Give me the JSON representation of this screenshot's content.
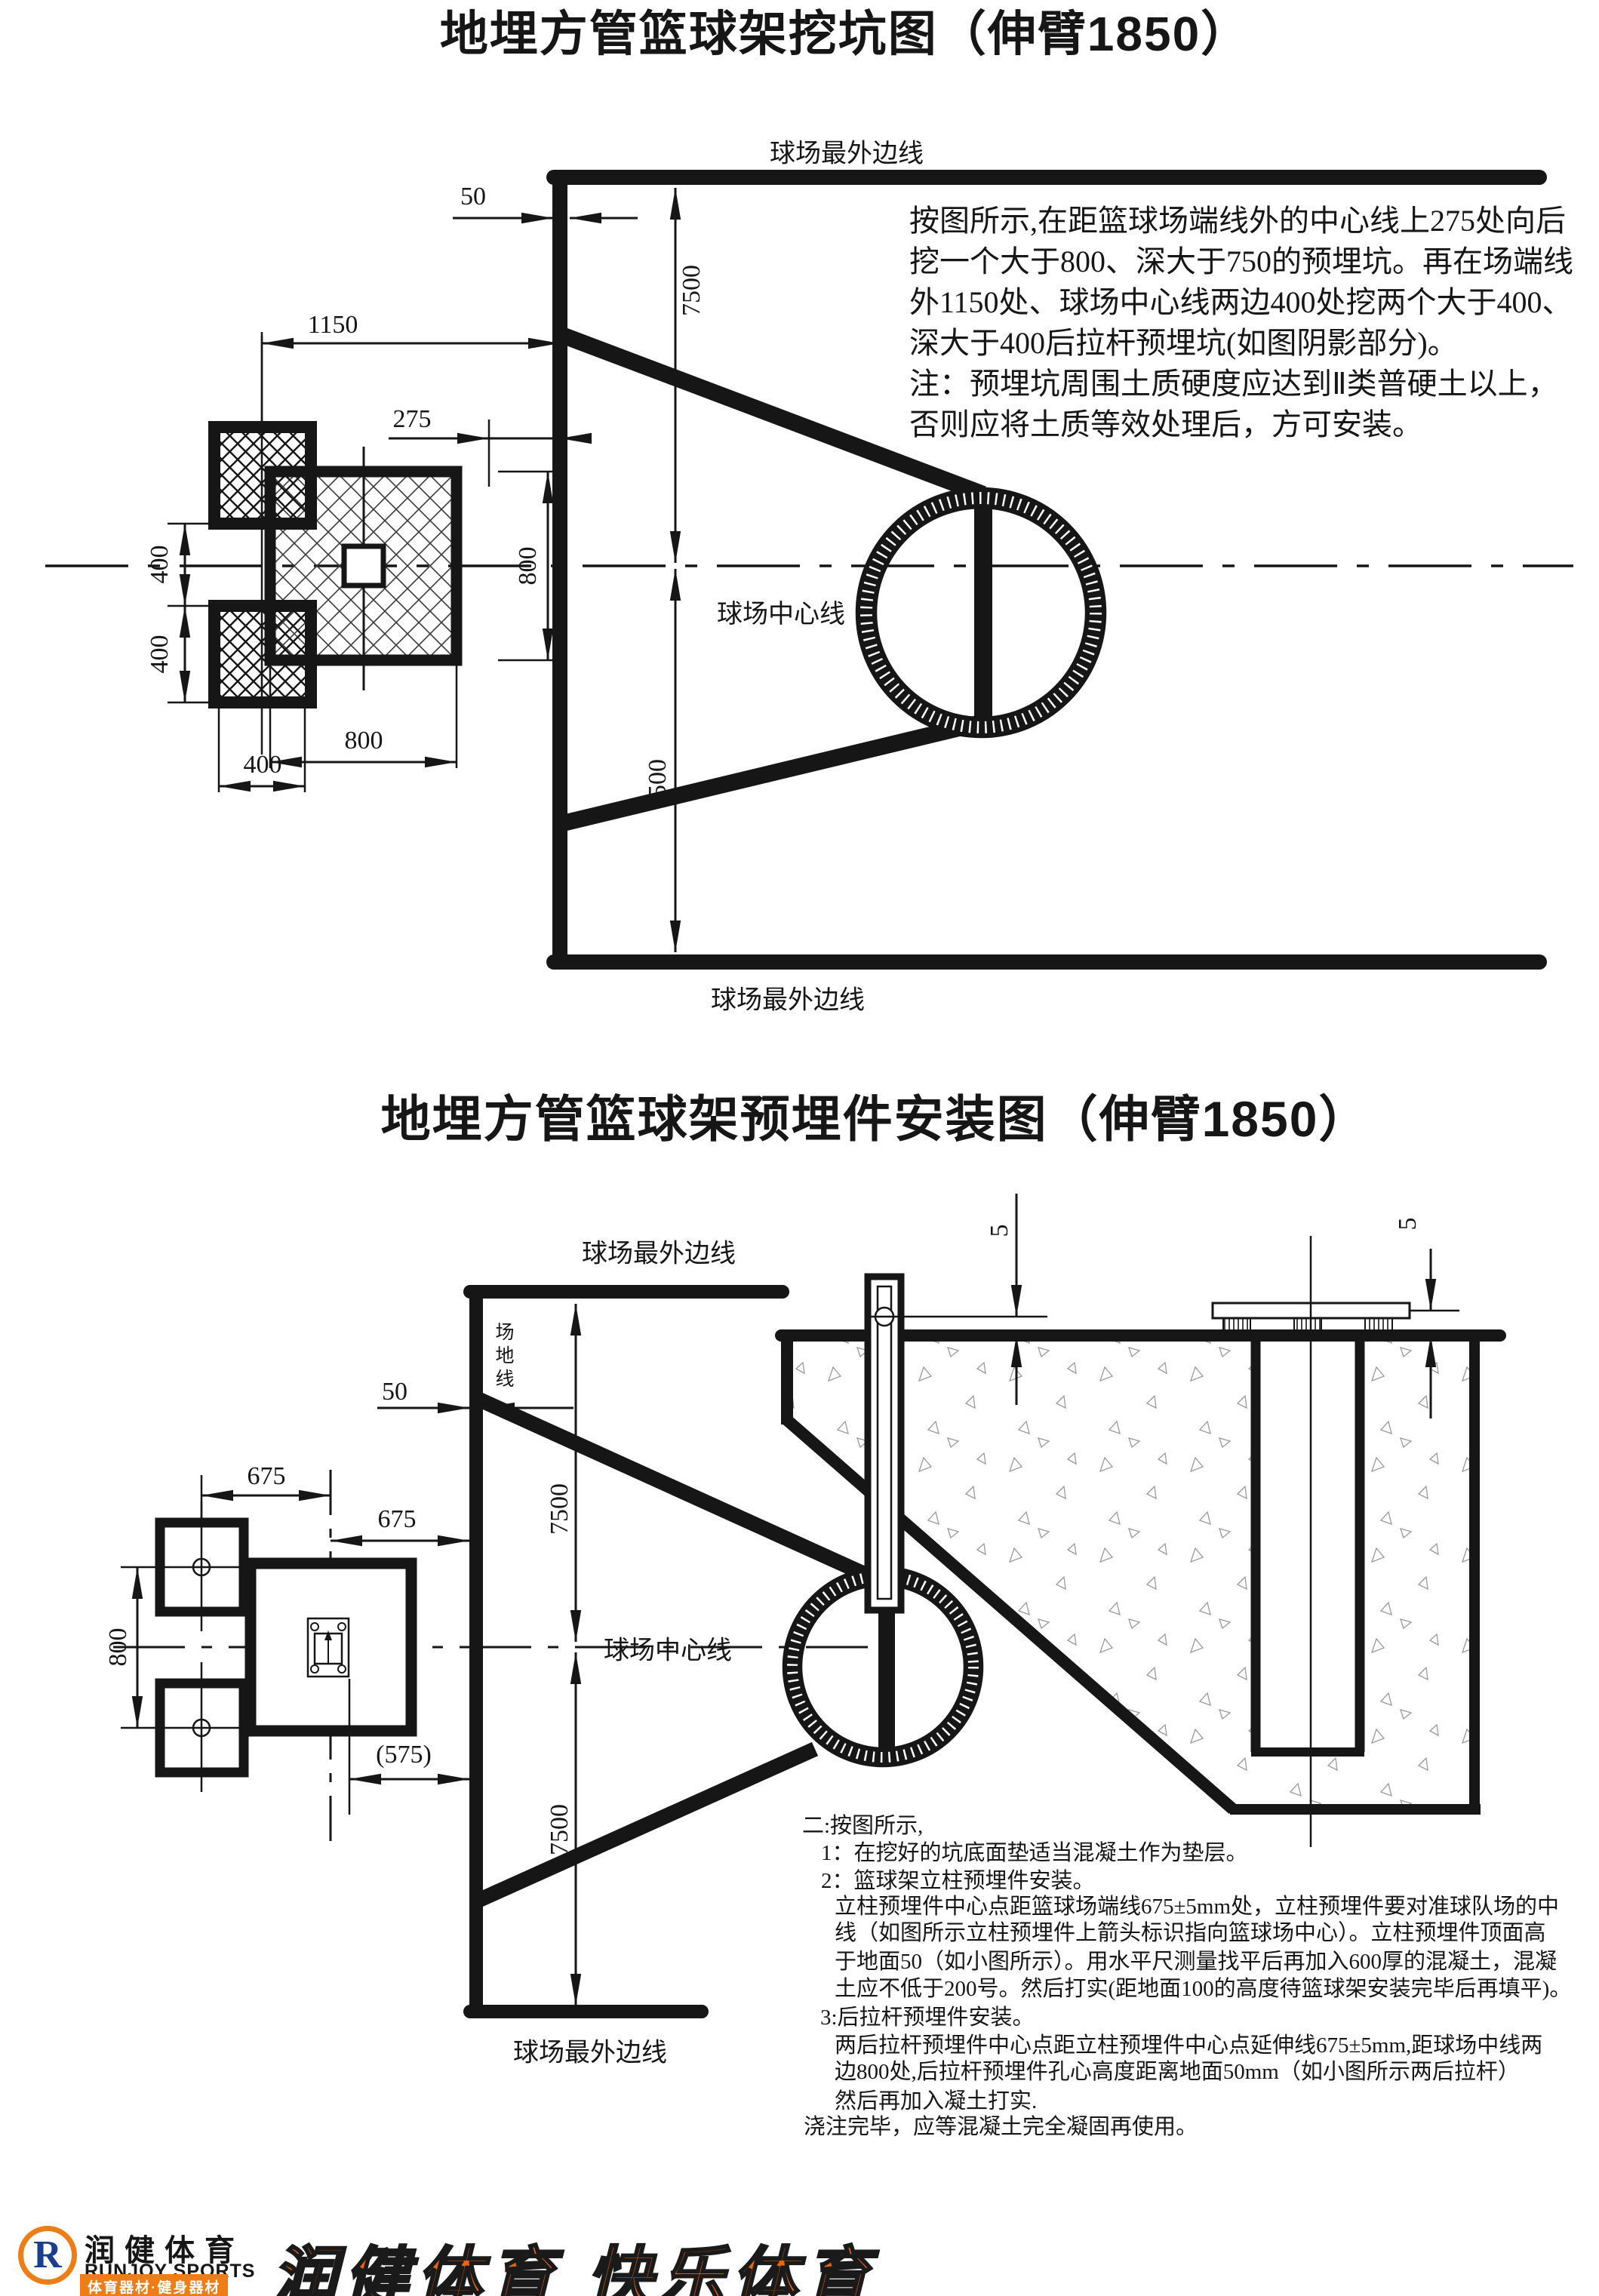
{
  "doc": {
    "title1": "地埋方管篮球架挖坑图（伸臂1850）",
    "title2": "地埋方管篮球架预埋件安装图（伸臂1850）"
  },
  "diagram1": {
    "label_outer_top": "球场最外边线",
    "label_outer_bottom": "球场最外边线",
    "label_center_line": "球场中心线",
    "note": "按图所示,在距篮球场端线外的中心线上275处向后\n挖一个大于800、深大于750的预埋坑。再在场端线\n外1150处、球场中心线两边400处挖两个大于400、\n深大于400后拉杆预埋坑(如图阴影部分)。\n注：预埋坑周围土质硬度应达到Ⅱ类普硬土以上，\n否则应将土质等效处理后，方可安装。",
    "dims": {
      "d50": "50",
      "d1150": "1150",
      "d275": "275",
      "d7500_top": "7500",
      "d7500_bottom": "7500",
      "d400_gap_a": "400",
      "d400_gap_b": "400",
      "d400_width": "400",
      "d800_height": "800",
      "d800_width": "800"
    }
  },
  "diagram2": {
    "label_outer_top": "球场最外边线",
    "label_outer_bottom": "球场最外边线",
    "label_center_line": "球场中心线",
    "label_field_line": "场地线",
    "dims": {
      "d50": "50",
      "d675_a": "675",
      "d675_b": "675",
      "d800": "800",
      "d575": "(575)",
      "d7500_top": "7500",
      "d7500_bottom": "7500",
      "d5_left": "5",
      "d5_right": "5"
    }
  },
  "notes2": {
    "lines": [
      "二:按图所示,",
      "1：在挖好的坑底面垫适当混凝土作为垫层。",
      "2：篮球架立柱预埋件安装。",
      "立柱预埋件中心点距篮球场端线675±5mm处，立柱预埋件要对准球队场的中",
      "线（如图所示立柱预埋件上箭头标识指向篮球场中心）。立柱预埋件顶面高",
      "于地面50（如小图所示）。用水平尺测量找平后再加入600厚的混凝土，混凝",
      "土应不低于200号。然后打实(距地面100的高度待篮球架安装完毕后再填平)。",
      "3:后拉杆预埋件安装。",
      "两后拉杆预埋件中心点距立柱预埋件中心点延伸线675±5mm,距球场中线两",
      "边800处,后拉杆预埋件孔心高度距离地面50mm（如小图所示两后拉杆）",
      "然后再加入凝土打实.",
      "浇注完毕，应等混凝土完全凝固再使用。"
    ]
  },
  "footer": {
    "logo_letter": "R",
    "brand_cn": "润健体育",
    "brand_en": "RUNJOY SPORTS",
    "brand_sub": "体育器材·健身器材",
    "slogan": "润健体育 快乐体育",
    "colors": {
      "orange": "#ee7d15",
      "slogan_red": "#e8650e",
      "blue": "#1b3f8f"
    }
  }
}
